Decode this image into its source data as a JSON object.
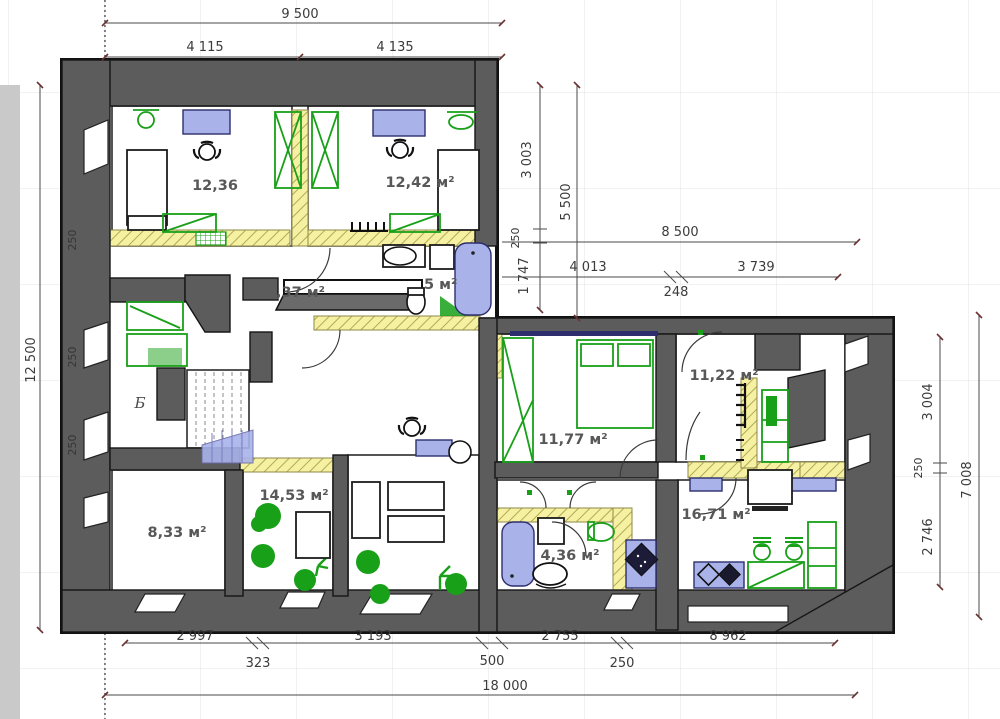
{
  "title": "floor-plan-drawing",
  "rooms": {
    "r1236": "12,36",
    "r1242": "12,42 м²",
    "hall": ",37 м²",
    "bath_top": "5 м²",
    "r1177": "11,77 м²",
    "r1122": "11,22 м²",
    "r833": "8,33 м²",
    "r1453": "14,53 м²",
    "r1671": "16,71 м²",
    "bath_bottom": "4,36 м²",
    "marker": "Б"
  },
  "dims": {
    "top_total": "9 500",
    "top_left": "4 115",
    "top_right": "4 135",
    "left_total": "12 500",
    "wall_250_a": "250",
    "wall_250_b": "250",
    "wall_250_c": "250",
    "v3003": "3 003",
    "v5500": "5 500",
    "v250": "250",
    "v1747": "1 747",
    "h8500": "8 500",
    "h4013": "4 013",
    "h248": "248",
    "h3739": "3 739",
    "r3004": "3 004",
    "r250": "250",
    "r2746": "2 746",
    "r7008": "7 008",
    "b2997": "2 997",
    "b323": "323",
    "b3193": "3 193",
    "b500": "500",
    "b2755": "2 755",
    "b250": "250",
    "b8962": "8 962",
    "b18000": "18 000"
  },
  "colors": {
    "wall_gray": "#5c5c5c",
    "partition_hatch": "#f6f0a2",
    "furniture_blue": "#a9b3ea",
    "furniture_green": "#18a018",
    "dimension_text": "#3b3b3b",
    "grid": "#dfe3e7"
  }
}
